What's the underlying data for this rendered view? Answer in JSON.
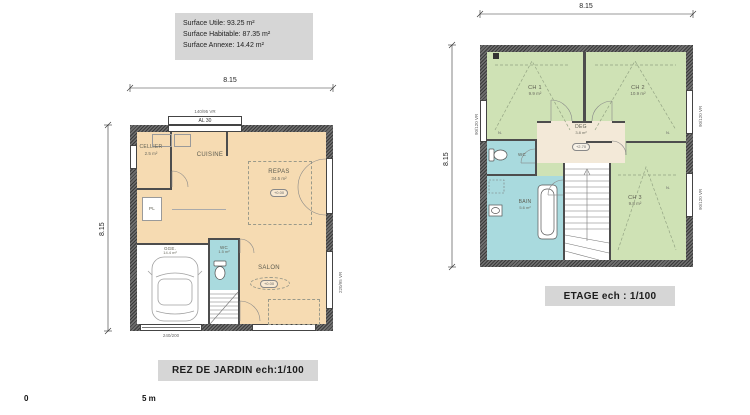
{
  "palette": {
    "living": "#f6dbb2",
    "bedroom": "#cfe2b5",
    "wet": "#a9dade",
    "wall": "#4d4d4d",
    "label_box": "#d6d6d6"
  },
  "legend": {
    "lines": [
      "Surface Utile: 93.25 m²",
      "Surface Habitable: 87.35 m²",
      "Surface  Annexe: 14.42 m²"
    ]
  },
  "scale_bar": {
    "zero": "0",
    "five": "5 m"
  },
  "ground_floor": {
    "title": "REZ DE JARDIN  ech:1/100",
    "dims": {
      "top": "8.15",
      "left": "8.15"
    },
    "tags": {
      "window_spec": "140/95 VR",
      "lintel": "AL 30",
      "bay_spec": "220/95 VR",
      "garage_door": "240/200",
      "closet": "PL"
    },
    "rooms": {
      "cellier": {
        "name": "CELLIER",
        "area": "2.5 m²"
      },
      "cuisine": {
        "name": "CUISINE"
      },
      "repas": {
        "name": "REPAS",
        "area": "34.5 m²",
        "level": "+0.00"
      },
      "salon": {
        "name": "SALON",
        "level": "+0.00"
      },
      "wc": {
        "name": "WC",
        "area": "1.5 m²"
      },
      "garage": {
        "name": "GGE.",
        "area": "14.4 m²"
      }
    }
  },
  "upper_floor": {
    "title": "ETAGE ech : 1/100",
    "dims": {
      "top": "8.15",
      "left": "8.15"
    },
    "tags": {
      "win_left": "90/120 VR",
      "win_right_1": "90/120 VR",
      "win_right_2": "90/120 VR",
      "closet_1": "N.",
      "closet_2": "N.",
      "closet_3": "N."
    },
    "rooms": {
      "ch1": {
        "name": "CH 1",
        "area": "9.9 m²"
      },
      "ch2": {
        "name": "CH 2",
        "area": "10.9 m²"
      },
      "ch3": {
        "name": "CH 3",
        "area": "9.8 m²"
      },
      "deg": {
        "name": "DEG",
        "area": "3.8 m²",
        "level": "+2.70"
      },
      "wc": {
        "name": "WC"
      },
      "bain": {
        "name": "BAIN",
        "area": "5.6 m²"
      }
    }
  }
}
